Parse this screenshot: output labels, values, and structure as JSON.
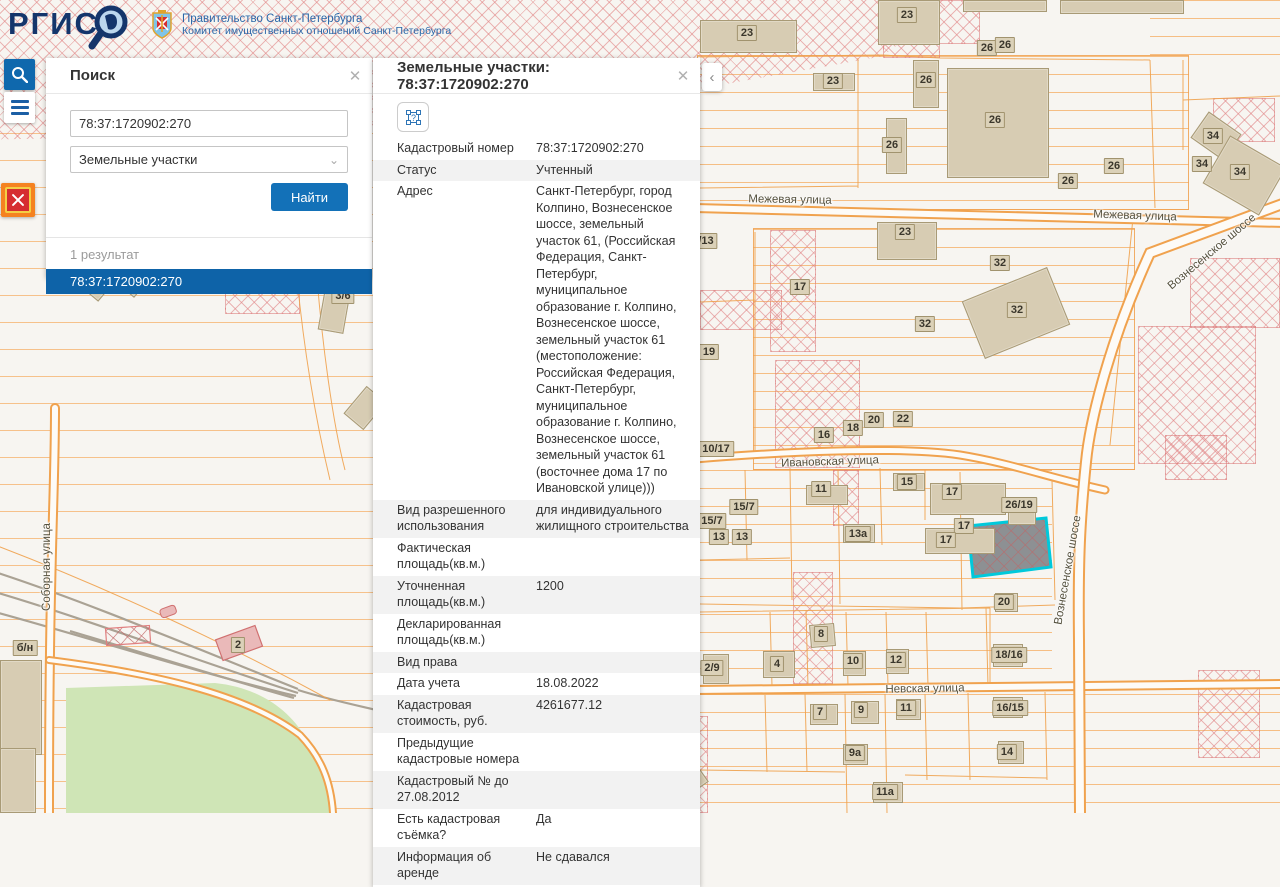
{
  "header": {
    "logo_text": "РГИС",
    "gov_line1": "Правительство Санкт-Петербурга",
    "gov_line2": "Комитет имущественных отношений Санкт-Петербурга"
  },
  "toolbar": {
    "search_button": "search",
    "menu_button": "menu",
    "emblem_button": "spb-emblem"
  },
  "search_panel": {
    "title": "Поиск",
    "close_label": "✕",
    "query_value": "78:37:1720902:270",
    "category_value": "Земельные участки",
    "chevron": "⌄",
    "find_button": "Найти",
    "results_count": "1 результат",
    "result_items": [
      "78:37:1720902:270"
    ]
  },
  "details_panel": {
    "title": "Земельные участки: 78:37:1720902:270",
    "close_label": "✕",
    "collapse_label": "‹",
    "geom_icon_label": "?",
    "rows": [
      {
        "label": "Кадастровый номер",
        "value": "78:37:1720902:270"
      },
      {
        "label": "Статус",
        "value": "Учтенный"
      },
      {
        "label": "Адрес",
        "value": "Санкт-Петербург, город Колпино, Вознесенское шоссе, земельный участок 61, (Российская Федерация, Санкт-Петербург, муниципальное образование г. Колпино, Вознесенское шоссе, земельный участок 61 (местоположение: Российская Федерация, Санкт-Петербург, муниципальное образование г. Колпино, Вознесенское шоссе, земельный участок 61 (восточнее дома 17 по Ивановской улице)))"
      },
      {
        "label": "Вид разрешенного использования",
        "value": "для индивидуального жилищного строительства"
      },
      {
        "label": "Фактическая площадь(кв.м.)",
        "value": ""
      },
      {
        "label": "Уточненная площадь(кв.м.)",
        "value": "1200"
      },
      {
        "label": "Декларированная площадь(кв.м.)",
        "value": ""
      },
      {
        "label": "Вид права",
        "value": ""
      },
      {
        "label": "Дата учета",
        "value": "18.08.2022"
      },
      {
        "label": "Кадастровая стоимость, руб.",
        "value": "4261677.12"
      },
      {
        "label": "Предыдущие кадастровые номера",
        "value": ""
      },
      {
        "label": "Кадастровый № до 27.08.2012",
        "value": ""
      },
      {
        "label": "Есть кадастровая съёмка?",
        "value": "Да"
      },
      {
        "label": "Информация об аренде",
        "value": "Не сдавался"
      }
    ]
  },
  "map": {
    "selected_parcel": "78:37:1720902:270",
    "street_labels": [
      [
        "Межевая улица",
        790,
        200,
        1
      ],
      [
        "Межевая улица",
        1135,
        216,
        2
      ],
      [
        "Ивановская улица",
        830,
        462,
        -2
      ],
      [
        "Невская улица",
        925,
        689,
        -1
      ],
      [
        "Вознесенское шоссе",
        1212,
        252,
        -40
      ],
      [
        "Вознесенское шоссе",
        1068,
        570,
        -80
      ],
      [
        "Соборная улица",
        47,
        567,
        -90
      ],
      [
        "Железнодорожная",
        614,
        802,
        74
      ]
    ],
    "parcel_labels": [
      [
        "23",
        907,
        15
      ],
      [
        "23",
        747,
        33
      ],
      [
        "26",
        987,
        48
      ],
      [
        "26",
        1005,
        45
      ],
      [
        "23",
        833,
        81
      ],
      [
        "26",
        926,
        80
      ],
      [
        "26",
        995,
        120
      ],
      [
        "26",
        892,
        145
      ],
      [
        "26",
        1068,
        181
      ],
      [
        "26",
        1114,
        166
      ],
      [
        "34",
        1213,
        136
      ],
      [
        "34",
        1202,
        164
      ],
      [
        "34",
        1240,
        172
      ],
      [
        "/13",
        706,
        241
      ],
      [
        "23",
        905,
        232
      ],
      [
        "32",
        1000,
        263
      ],
      [
        "32",
        1017,
        310
      ],
      [
        "32",
        925,
        324
      ],
      [
        "17",
        800,
        287
      ],
      [
        "19",
        709,
        352
      ],
      [
        "10/17",
        716,
        449
      ],
      [
        "16",
        824,
        435
      ],
      [
        "18",
        853,
        428
      ],
      [
        "20",
        874,
        420
      ],
      [
        "22",
        903,
        419
      ],
      [
        "11",
        821,
        489
      ],
      [
        "15",
        907,
        482
      ],
      [
        "15/7",
        744,
        507
      ],
      [
        "15/7",
        712,
        521
      ],
      [
        "13",
        719,
        537
      ],
      [
        "13",
        742,
        537
      ],
      [
        "13а",
        858,
        534
      ],
      [
        "17",
        952,
        492
      ],
      [
        "17",
        964,
        526
      ],
      [
        "17",
        946,
        540
      ],
      [
        "26/19",
        1019,
        505
      ],
      [
        "20",
        1004,
        602
      ],
      [
        "2/9",
        712,
        668
      ],
      [
        "4",
        777,
        664
      ],
      [
        "8",
        821,
        634
      ],
      [
        "10",
        853,
        661
      ],
      [
        "12",
        896,
        660
      ],
      [
        "18/16",
        1009,
        655
      ],
      [
        "7",
        820,
        712
      ],
      [
        "9",
        861,
        710
      ],
      [
        "11",
        906,
        708
      ],
      [
        "16/15",
        1010,
        708
      ],
      [
        "9а",
        855,
        753
      ],
      [
        "14",
        1007,
        752
      ],
      [
        "11а",
        885,
        792
      ],
      [
        "3/6",
        343,
        296
      ],
      [
        "б/н",
        25,
        648
      ],
      [
        "2",
        238,
        645
      ],
      [
        "8",
        547,
        735
      ],
      [
        "8",
        560,
        789
      ],
      [
        "9/2",
        663,
        777
      ]
    ],
    "buildings": [
      [
        878,
        0,
        62,
        45,
        0
      ],
      [
        700,
        20,
        97,
        33,
        0
      ],
      [
        963,
        0,
        84,
        12,
        0
      ],
      [
        1060,
        0,
        124,
        14,
        0
      ],
      [
        813,
        73,
        42,
        18,
        0
      ],
      [
        913,
        60,
        26,
        48,
        0
      ],
      [
        947,
        68,
        102,
        110,
        0
      ],
      [
        886,
        118,
        21,
        56,
        0
      ],
      [
        1196,
        120,
        40,
        32,
        35
      ],
      [
        1212,
        148,
        65,
        55,
        30
      ],
      [
        877,
        222,
        60,
        38,
        0
      ],
      [
        970,
        282,
        92,
        62,
        -22
      ],
      [
        322,
        280,
        26,
        52,
        10
      ],
      [
        352,
        390,
        26,
        36,
        40
      ],
      [
        88,
        283,
        17,
        15,
        40
      ],
      [
        129,
        287,
        9,
        9,
        40
      ],
      [
        930,
        483,
        76,
        32,
        0
      ],
      [
        925,
        528,
        70,
        26,
        0
      ],
      [
        806,
        485,
        42,
        20,
        0
      ],
      [
        893,
        473,
        32,
        18,
        0
      ],
      [
        843,
        524,
        32,
        19,
        0
      ],
      [
        1008,
        509,
        28,
        16,
        0
      ],
      [
        703,
        654,
        26,
        30,
        0
      ],
      [
        763,
        651,
        32,
        27,
        0
      ],
      [
        810,
        624,
        25,
        23,
        -5
      ],
      [
        843,
        651,
        23,
        25,
        0
      ],
      [
        886,
        649,
        23,
        25,
        0
      ],
      [
        993,
        644,
        30,
        23,
        0
      ],
      [
        995,
        593,
        23,
        19,
        0
      ],
      [
        810,
        704,
        28,
        21,
        0
      ],
      [
        851,
        701,
        28,
        23,
        0
      ],
      [
        896,
        699,
        25,
        21,
        0
      ],
      [
        993,
        697,
        30,
        21,
        0
      ],
      [
        843,
        744,
        25,
        21,
        0
      ],
      [
        998,
        741,
        26,
        23,
        0
      ],
      [
        873,
        782,
        30,
        21,
        0
      ],
      [
        0,
        660,
        42,
        95,
        0
      ],
      [
        0,
        748,
        36,
        65,
        0
      ],
      [
        488,
        720,
        32,
        30,
        -35
      ],
      [
        498,
        752,
        78,
        62,
        -30
      ],
      [
        644,
        760,
        58,
        42,
        -35
      ]
    ],
    "colors": {
      "parcel_line": "#f0a24e",
      "hatch_pink": "#e08080",
      "building_fill": "#d7ccb3",
      "park_green": "#cfe5b6",
      "railway_gray": "#aaa294",
      "selection_cyan": "#00c9db",
      "selected_fill": "#8d9093"
    }
  }
}
